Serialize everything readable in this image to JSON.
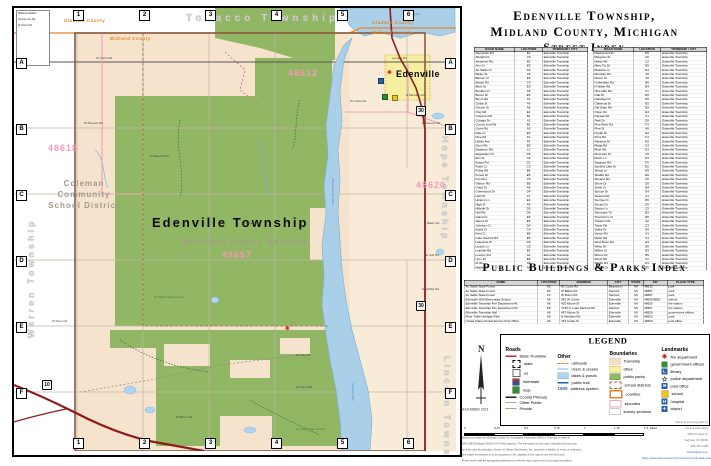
{
  "accent_colors": {
    "county_line": "#e8862a",
    "trunkline": "#8e1b1b",
    "water": "#aacfe8",
    "forest": "#92b764",
    "township_fill": "#f6e3cd",
    "zipcode_pink": "#f49ab4",
    "city_yellow": "#f6eea0"
  },
  "panel": {
    "title": {
      "line1": "Edenville Township,",
      "line2": "Midland County, Michigan",
      "line3": "Street Index"
    },
    "pb_heading": "Public Buildings & Parks Index"
  },
  "street_index": {
    "headers": [
      "ROAD NAME",
      "LOCATION",
      "TOWNSHIP / CITY"
    ],
    "township_default": "Edenville Township",
    "col1": [
      [
        "Alamando Rd",
        "E1"
      ],
      [
        "Albright Dr",
        "C5"
      ],
      [
        "Anderson Rd",
        "B2"
      ],
      [
        "Ann Ct",
        "E5"
      ],
      [
        "Au Sable Ct",
        "D2"
      ],
      [
        "Bailey St",
        "A6"
      ],
      [
        "Balmer Ct",
        "E5"
      ],
      [
        "Beach Rd",
        "C4"
      ],
      [
        "Birch Dr",
        "E5"
      ],
      [
        "Boulder Ct",
        "D5"
      ],
      [
        "Brown Dr",
        "E5"
      ],
      [
        "Burns Rd",
        "F2"
      ],
      [
        "Cedar St",
        "A6"
      ],
      [
        "Church St",
        "A6"
      ],
      [
        "Clay Rd",
        "E4"
      ],
      [
        "Coleman Rd",
        "B1"
      ],
      [
        "Cottage Dr",
        "A2"
      ],
      [
        "County Line Rd",
        "B1"
      ],
      [
        "Curtis Rd",
        "A3"
      ],
      [
        "Dale Ct",
        "E5"
      ],
      [
        "Dice Rd",
        "F4"
      ],
      [
        "Dublin Ave",
        "F5"
      ],
      [
        "Dunn Rd",
        "B3"
      ],
      [
        "Eagleson Rd",
        "C2"
      ],
      [
        "Edgewater Dr",
        "D5"
      ],
      [
        "Elm St",
        "A6"
      ],
      [
        "Evans Rd",
        "D1"
      ],
      [
        "Fawn Ct",
        "C3"
      ],
      [
        "Finlay Rd",
        "B4"
      ],
      [
        "Forest Dr",
        "E5"
      ],
      [
        "Fox Run",
        "C5"
      ],
      [
        "Gibson Rd",
        "B5"
      ],
      [
        "Grant St",
        "A6"
      ],
      [
        "Greenwood Dr",
        "D4"
      ],
      [
        "Hall Rd",
        "C1"
      ],
      [
        "Hickory Ln",
        "E4"
      ],
      [
        "High St",
        "A6"
      ],
      [
        "Hillside Dr",
        "D5"
      ],
      [
        "Hull Rd",
        "D6"
      ],
      [
        "Island Ct",
        "E5"
      ],
      [
        "James Dr",
        "E5"
      ],
      [
        "Johnson Ct",
        "D4"
      ],
      [
        "Kayla Ct",
        "C4"
      ],
      [
        "Kent Ct",
        "B5"
      ],
      [
        "Lake Sanford Rd",
        "E5"
      ],
      [
        "Lakeview Dr",
        "D5"
      ],
      [
        "Lancer Ln",
        "C5"
      ],
      [
        "Leiphart Rd",
        "B2"
      ],
      [
        "Lovejoy Rd",
        "A4"
      ],
      [
        "Lynn Dr",
        "E5"
      ],
      [
        "M-30",
        "A5"
      ],
      [
        "Maple St",
        "A6"
      ]
    ],
    "col2": [
      [
        "Maplewood Dr",
        "D5"
      ],
      [
        "Margaret St",
        "A6"
      ],
      [
        "Marks Rd",
        "C2"
      ],
      [
        "Mary Try Dr",
        "E5"
      ],
      [
        "Meadow Ln",
        "D4"
      ],
      [
        "Meridian Rd",
        "A5"
      ],
      [
        "Moore St",
        "A6"
      ],
      [
        "N Meridian Rd",
        "B5"
      ],
      [
        "N Water Rd",
        "B4"
      ],
      [
        "Nine Mile Rd",
        "F1"
      ],
      [
        "Oak Dr",
        "E5"
      ],
      [
        "Oakridge Dr",
        "D5"
      ],
      [
        "Oakwood Dr",
        "E5"
      ],
      [
        "Old State Rd",
        "B3"
      ],
      [
        "Olson Rd",
        "E3"
      ],
      [
        "Pappas Rd",
        "C1"
      ],
      [
        "Park Dr",
        "D5"
      ],
      [
        "Pine River Rd",
        "F3"
      ],
      [
        "Pine St",
        "A6"
      ],
      [
        "Poplar Dr",
        "E4"
      ],
      [
        "Price Rd",
        "F4"
      ],
      [
        "Rainbow Dr",
        "D5"
      ],
      [
        "Ridge Rd",
        "C4"
      ],
      [
        "River Rd",
        "E3"
      ],
      [
        "Riverside Dr",
        "C5"
      ],
      [
        "Robin Ln",
        "D4"
      ],
      [
        "Saginaw Rd",
        "F5"
      ],
      [
        "Sanford Lake Dr",
        "E5"
      ],
      [
        "Shady Ln",
        "D5"
      ],
      [
        "Shaffer Rd",
        "E6"
      ],
      [
        "Shearer Rd",
        "C6"
      ],
      [
        "Shore Dr",
        "D5"
      ],
      [
        "Smith Ct",
        "B4"
      ],
      [
        "Spruce Dr",
        "E4"
      ],
      [
        "Stewart Rd",
        "C1"
      ],
      [
        "Sunrise Ct",
        "D5"
      ],
      [
        "Sunset Dr",
        "D5"
      ],
      [
        "Sylvan Ln",
        "C5"
      ],
      [
        "Tamarack Trl",
        "B3"
      ],
      [
        "Thornberry Ct",
        "D5"
      ],
      [
        "Tobacco Rd",
        "A2"
      ],
      [
        "Tower Rd",
        "C3"
      ],
      [
        "Valley Dr",
        "E4"
      ],
      [
        "Vance Rd",
        "A1"
      ],
      [
        "Water Rd",
        "C4"
      ],
      [
        "West River Rd",
        "E3"
      ],
      [
        "White Dr",
        "D5"
      ],
      [
        "Willow Ct",
        "E5"
      ],
      [
        "Wixom Dr",
        "B5"
      ],
      [
        "Wood Rd",
        "F2"
      ],
      [
        "Wright Rd",
        "D1"
      ],
      [
        "Virginia Dr",
        "E5"
      ]
    ]
  },
  "buildings_index": {
    "headers": [
      "NAME",
      "LOCATION",
      "ADDRESS",
      "CITY",
      "STATE",
      "ZIP",
      "PLACE TYPE"
    ],
    "rows": [
      [
        "Au Sable State Forest",
        "A2",
        "W. Curtis Rd",
        "Beaverton",
        "MI",
        "48612",
        "park"
      ],
      [
        "Au Sable State Forest",
        "D2",
        "W Baker Rd",
        "Sanford",
        "MI",
        "48657",
        "park"
      ],
      [
        "Au Sable State Forest",
        "F3",
        "W Burns Rd",
        "Sanford",
        "MI",
        "48657",
        "park"
      ],
      [
        "Edenville SDA Elementary School",
        "A6",
        "342 W. Curtis",
        "Edenville",
        "MI",
        "48620-8802",
        "school"
      ],
      [
        "Edenville Township Fire Department #1",
        "A6",
        "420 Moore St",
        "Edenville",
        "MI",
        "48620",
        "fire station"
      ],
      [
        "Edenville Township Fire Department #2",
        "E5",
        "4736 N. Lake Sanford Rd",
        "Sanford",
        "MI",
        "48657",
        "fire station"
      ],
      [
        "Edenville Township Hall",
        "A6",
        "467 Moore St",
        "Edenville",
        "MI",
        "48620",
        "government offices"
      ],
      [
        "River Trails Heritage Park",
        "A6",
        "N Meridian Rd",
        "Edenville",
        "MI",
        "48620",
        "park"
      ],
      [
        "United States Postal Service Post Office",
        "A6",
        "467 Cedar St",
        "Edenville",
        "MI",
        "48620",
        "post office"
      ]
    ]
  },
  "legend": {
    "title": "LEGEND",
    "roads": {
      "title": "Roads",
      "trunkline_label": "State Trunkline",
      "shields": [
        [
          "state",
          "state"
        ],
        [
          "us",
          "us"
        ],
        [
          "int",
          "interstate"
        ],
        [
          "loop",
          "loop"
        ]
      ],
      "lines": [
        [
          "county",
          "County Primary"
        ],
        [
          "other",
          "Other Public"
        ],
        [
          "private",
          "Private"
        ]
      ]
    },
    "other": {
      "title": "Other",
      "items": [
        [
          "rail",
          "railroads"
        ],
        [
          "river",
          "rivers & creeks"
        ],
        [
          "lakes",
          "lakes & ponds"
        ],
        [
          "trail",
          "public trail"
        ]
      ],
      "address_number": "1500",
      "address_label": "address system"
    },
    "boundaries": {
      "title": "Boundaries",
      "items": [
        [
          "township",
          "Township"
        ],
        [
          "cities",
          "cities"
        ],
        [
          "parks",
          "public parks"
        ],
        [
          "school",
          "school districts"
        ],
        [
          "counties",
          "counties"
        ],
        [
          "zip",
          "zipcodes"
        ],
        [
          "survey",
          "survey sections"
        ]
      ]
    },
    "landmarks": {
      "title": "Landmarks",
      "items": [
        [
          "fire",
          "fire department"
        ],
        [
          "gov",
          "government offices"
        ],
        [
          "library",
          "library"
        ],
        [
          "police",
          "police department"
        ],
        [
          "post",
          "post office"
        ],
        [
          "school",
          "school"
        ],
        [
          "hospital",
          "hospital"
        ],
        [
          "airport",
          "airport"
        ]
      ]
    }
  },
  "scale": {
    "labels": [
      "0",
      "0.25",
      "0.5",
      "0.75",
      "1",
      "1.25",
      "1.5"
    ],
    "unit": "Miles"
  },
  "map_date": "DECEMBER 2021",
  "compass_label": "N",
  "disclaimer": [
    "Background data from Michigan Center For Geographic Information (MCGI).  This map is drawn in",
    "NAD 1983 Michigan GeoRef (US Feet) projection.  The information on this map is thought to be accurate",
    "as of the date of publication.  Known as 'Wixom Dambreach, Inc.' assumes no liability for errors or omissions",
    "and makes no warranty as to the accuracy or the suitability of this map for any intended uses.",
    "Please check with the appropriate authorities to verify the map content and for accurate boundaries."
  ],
  "credits": {
    "lines": [
      "Mapping and Copyright by",
      "Consult Data Wrks",
      "2052 Durham Dr",
      "Saginaw, MI  48609",
      "989-781-1308"
    ],
    "links": [
      "cdwrks@aol.com",
      "https://www.avenzamaps.com/vendor/consult-data-wrks-web-store"
    ]
  },
  "map": {
    "grid": {
      "cols": [
        "1",
        "2",
        "3",
        "4",
        "5",
        "6"
      ],
      "rows": [
        "A",
        "B",
        "C",
        "D",
        "E",
        "F"
      ]
    },
    "corner_box": [
      "Midland  Gladwin",
      "County Line Rd",
      "W Vance Rd"
    ],
    "labels": [
      {
        "t": "Gladwin County",
        "c": "county",
        "x": 50,
        "y": 10
      },
      {
        "t": "Midland County",
        "c": "county",
        "x": 96,
        "y": 28
      },
      {
        "t": "Tobacco Township",
        "c": "twp-h",
        "x": 172,
        "y": 5
      },
      {
        "t": "Gladwin County",
        "c": "county",
        "x": 358,
        "y": 12
      },
      {
        "t": "Midland County",
        "c": "county",
        "x": 358,
        "y": 22
      },
      {
        "t": "Warren Township",
        "c": "twp-vl",
        "x": 12,
        "y": 330
      },
      {
        "t": "Hope Township",
        "c": "twp-v",
        "x": 436,
        "y": 128
      },
      {
        "t": "Lincoln Township",
        "c": "twp-v",
        "x": 438,
        "y": 348
      },
      {
        "t": "Edenville Township",
        "c": "big",
        "x": 138,
        "y": 207
      },
      {
        "t": "Meridian Public Schools",
        "c": "school",
        "x": 168,
        "y": 229
      },
      {
        "t": "Coleman Community School District",
        "c": "school2",
        "x": 28,
        "y": 170,
        "w": 84
      },
      {
        "t": "Edenville",
        "c": "town",
        "x": 382,
        "y": 61
      },
      {
        "t": "48612",
        "c": "zip",
        "x": 274,
        "y": 60
      },
      {
        "t": "48618",
        "c": "zip",
        "x": 34,
        "y": 135
      },
      {
        "t": "48620",
        "c": "zip",
        "x": 402,
        "y": 172
      },
      {
        "t": "48657",
        "c": "zip",
        "x": 208,
        "y": 242
      },
      {
        "t": "Wixom Lake",
        "c": "water",
        "x": 390,
        "y": 5
      },
      {
        "t": "Tittabawassee River",
        "c": "water-v",
        "x": 320,
        "y": 170
      },
      {
        "t": "Sanford Lake",
        "c": "water-v",
        "x": 340,
        "y": 375
      },
      {
        "t": "Au Sable State Forest",
        "c": "forest",
        "x": 140,
        "y": 288
      },
      {
        "t": "Au Sable State Forest",
        "c": "forest",
        "x": 282,
        "y": 420
      },
      {
        "t": "W Curtis Rd",
        "c": "road",
        "x": 82,
        "y": 49
      },
      {
        "t": "W Curtis Rd",
        "c": "road",
        "x": 336,
        "y": 92
      },
      {
        "t": "Lovejoy Rd",
        "c": "road",
        "x": 378,
        "y": 49
      },
      {
        "t": "N Meridian Rd",
        "c": "road",
        "x": 392,
        "y": 86
      },
      {
        "t": "W Shearer Rd",
        "c": "road",
        "x": 70,
        "y": 114
      },
      {
        "t": "E Shearer Rd",
        "c": "road",
        "x": 408,
        "y": 114
      },
      {
        "t": "W Stewart Rd",
        "c": "road",
        "x": 136,
        "y": 147
      },
      {
        "t": "W Baker Rd",
        "c": "road",
        "x": 228,
        "y": 214
      },
      {
        "t": "E Baker Rd",
        "c": "road",
        "x": 410,
        "y": 214
      },
      {
        "t": "E Hull Rd",
        "c": "road",
        "x": 412,
        "y": 246
      },
      {
        "t": "E Shaffer Rd",
        "c": "road",
        "x": 408,
        "y": 280
      },
      {
        "t": "W River Rd",
        "c": "road",
        "x": 38,
        "y": 312
      },
      {
        "t": "W Clay Rd",
        "c": "road",
        "x": 282,
        "y": 346
      },
      {
        "t": "W Olson Rd",
        "c": "road",
        "x": 282,
        "y": 378
      },
      {
        "t": "W Burns Rd",
        "c": "road",
        "x": 162,
        "y": 408
      },
      {
        "t": "30",
        "c": "shield-state",
        "x": 402,
        "y": 98
      },
      {
        "t": "30",
        "c": "shield-state",
        "x": 402,
        "y": 293
      },
      {
        "t": "10",
        "c": "shield-us",
        "x": 28,
        "y": 372
      },
      {
        "t": "✷",
        "c": "mi-fire",
        "n": "fire-station-icon",
        "x": 372,
        "y": 62
      },
      {
        "t": "✷",
        "c": "mi-fire",
        "n": "fire-station-icon",
        "x": 270,
        "y": 318
      },
      {
        "t": "",
        "c": "mi-sq mi-post",
        "n": "post-office-icon",
        "x": 364,
        "y": 70
      },
      {
        "t": "",
        "c": "mi-sq mi-gov",
        "n": "government-office-icon",
        "x": 368,
        "y": 86
      },
      {
        "t": "",
        "c": "mi-sq mi-school",
        "n": "school-icon",
        "x": 378,
        "y": 87
      }
    ]
  }
}
